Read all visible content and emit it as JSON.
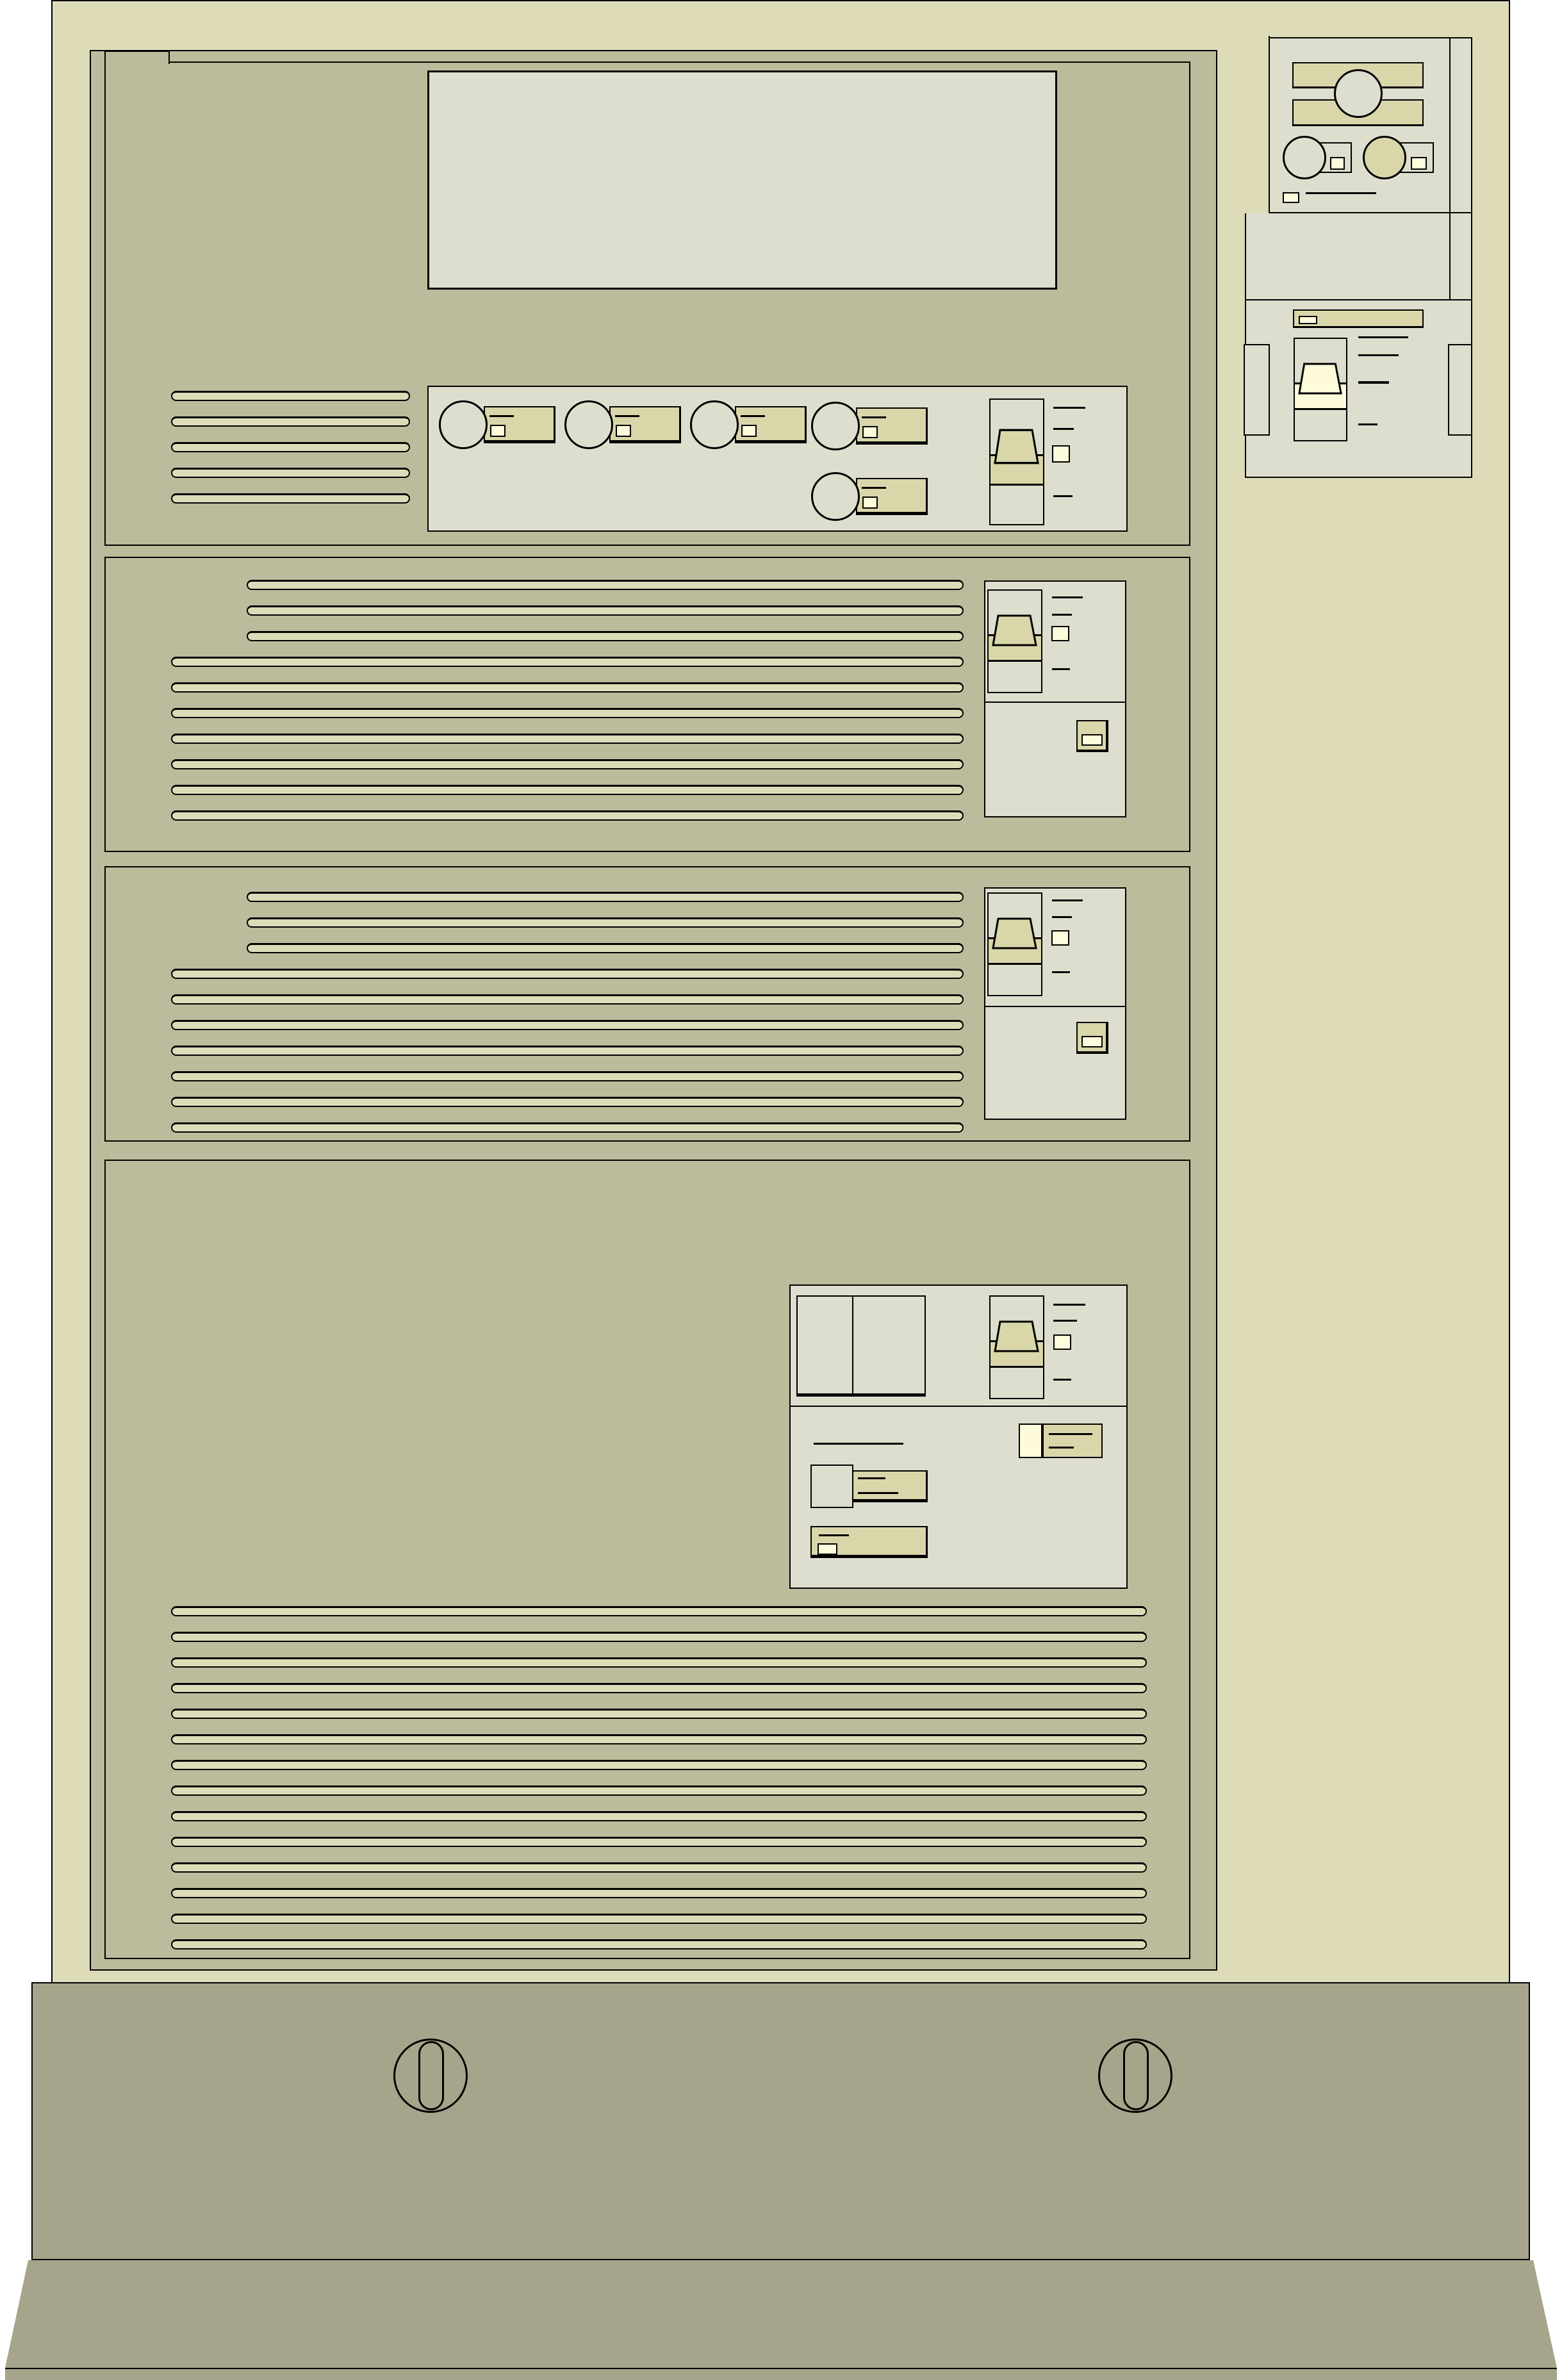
{
  "description": "Technical line illustration of an equipment cabinet front view with four rack units, ventilation slots, rotary knobs, rocker switches, indicator lights, a side control panel and a pedestal base with two quarter-turn latches",
  "colors": {
    "page": "#ffffff",
    "shell": "#dedcb8",
    "panel": "#bcbb9b",
    "light": "#dedecf",
    "tan": "#d9d6aa",
    "cream": "#fdfbdb",
    "pedestal": "#a6a58b",
    "outline": "#000000"
  },
  "cabinet": {
    "rack_units": [
      {
        "name": "unit-1",
        "blank_display": true,
        "vent_slots": 5,
        "rotary_knobs": 5,
        "rocker_switches": 1,
        "indicator_squares": 6
      },
      {
        "name": "unit-2",
        "vent_slots_short": 3,
        "vent_slots_long": 7,
        "rocker_switches": 1,
        "square_buttons": 1,
        "indicator_squares": 1
      },
      {
        "name": "unit-3",
        "vent_slots_short": 3,
        "vent_slots_long": 7,
        "rocker_switches": 1,
        "square_buttons": 1,
        "indicator_squares": 1
      },
      {
        "name": "unit-4",
        "vent_slots": 14,
        "rocker_switches": 1,
        "blank_dual_window": true,
        "label_plates": 3,
        "indicator_squares": 3
      }
    ],
    "side_panel": {
      "key_switch": 1,
      "rotary_controls": 2,
      "rocker_switches": 1,
      "tan_label_bars": 3,
      "indicator_squares": 4
    },
    "base": {
      "quarter_turn_latches": 2
    }
  },
  "vent_groups": [
    {
      "id": "vents-u1",
      "count": 5
    },
    {
      "id": "vents-u2-short",
      "count": 3
    },
    {
      "id": "vents-u2-long",
      "count": 7
    },
    {
      "id": "vents-u3-short",
      "count": 3
    },
    {
      "id": "vents-u3-long",
      "count": 7
    },
    {
      "id": "vents-u4",
      "count": 14
    }
  ]
}
